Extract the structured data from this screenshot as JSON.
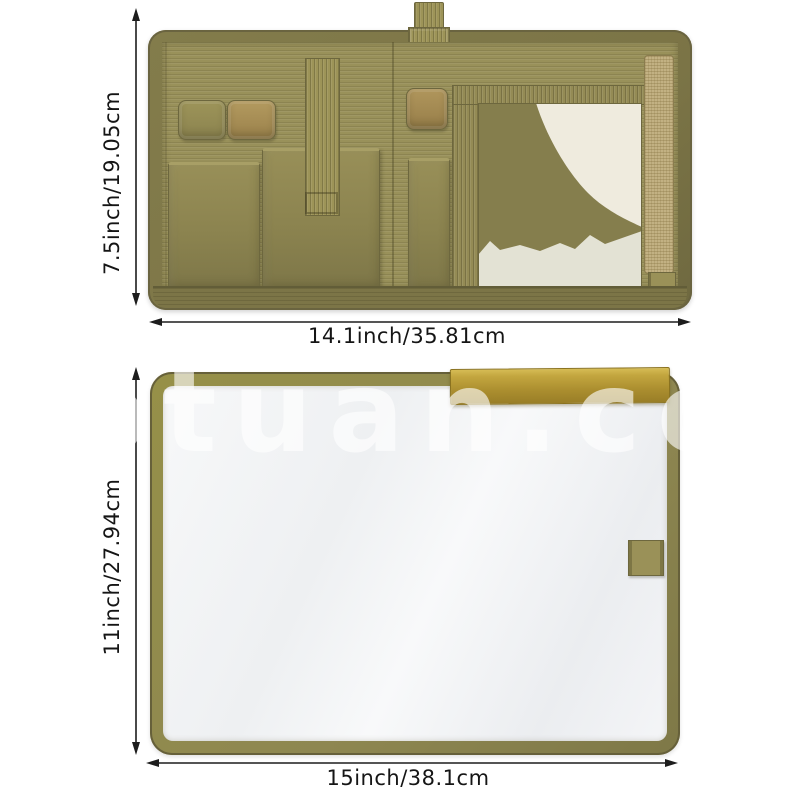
{
  "watermark": {
    "text": "yptuan.co",
    "color": "#ffffff"
  },
  "dimensions": {
    "top_view": {
      "height": "7.5inch/19.05cm",
      "width": "14.1inch/35.81cm"
    },
    "bottom_view": {
      "height": "11inch/27.94cm",
      "width": "15inch/38.1cm"
    }
  },
  "icons": {
    "arrows": [
      "vertical-double-arrow-top",
      "horizontal-double-arrow-top",
      "vertical-double-arrow-bottom",
      "horizontal-double-arrow-bottom"
    ]
  },
  "colors": {
    "fabric_olive": "#8f8853",
    "fabric_dark": "#6e683e",
    "fabric_light": "#a39b63",
    "webbing_tan": "#c2b183",
    "elastic_tan": "#a98f58",
    "gold_flap": "#b29535",
    "clear_panel_white": "#f3f4f6",
    "dimension_text": "#151515"
  }
}
